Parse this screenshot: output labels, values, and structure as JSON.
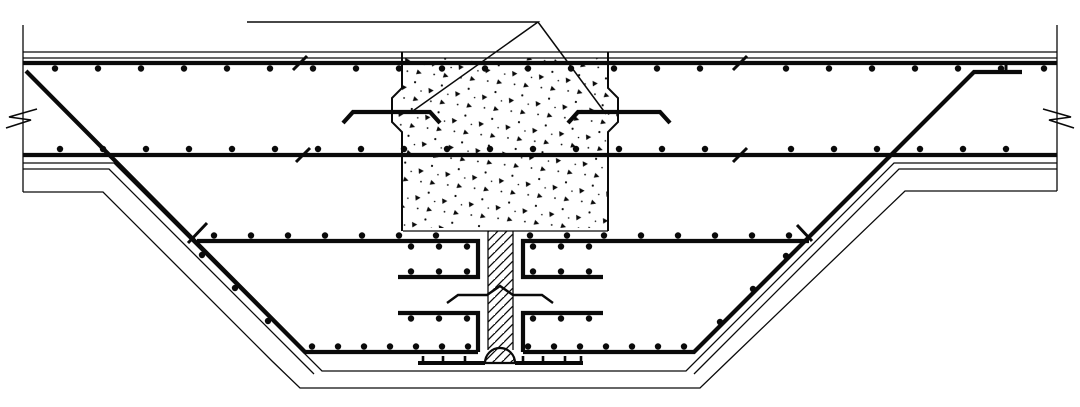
{
  "drawing": {
    "canvas": {
      "width": 1080,
      "height": 407,
      "background": "#ffffff",
      "ink": "#0a0a0a"
    },
    "stipple_block": {
      "name": "concrete-column-stub-stipple",
      "points": [
        [
          402,
          58
        ],
        [
          402,
          88
        ],
        [
          392,
          98
        ],
        [
          392,
          122
        ],
        [
          402,
          132
        ],
        [
          402,
          228
        ],
        [
          608,
          228
        ],
        [
          608,
          132
        ],
        [
          618,
          122
        ],
        [
          618,
          98
        ],
        [
          608,
          88
        ],
        [
          608,
          58
        ]
      ]
    },
    "joint_strip": {
      "name": "construction-joint-hatch",
      "x": 488.5,
      "y": 231,
      "w": 24,
      "h": 120
    },
    "waterstop_bulb": {
      "name": "waterstop-bulb",
      "cx": 500,
      "cy": 363,
      "r": 15,
      "stroke_width": 2.2
    },
    "line_groups": [
      {
        "name": "slab-face-lines",
        "width": 1.3,
        "lines": [
          [
            [
              23,
              52
            ],
            [
              1057,
              52
            ]
          ],
          [
            [
              23,
              58
            ],
            [
              1057,
              58
            ]
          ],
          [
            [
              23,
              163
            ],
            [
              114,
              163
            ],
            [
              322,
              371
            ],
            [
              686,
              371
            ],
            [
              894,
              163
            ],
            [
              1057,
              163
            ]
          ],
          [
            [
              23,
              169
            ],
            [
              109,
              169
            ],
            [
              314,
              374
            ]
          ],
          [
            [
              1057,
              169
            ],
            [
              899,
              169
            ],
            [
              694,
              374
            ]
          ]
        ]
      },
      {
        "name": "excavation-outline",
        "width": 1.3,
        "lines": [
          [
            [
              23,
              192
            ],
            [
              103,
              192
            ],
            [
              272,
              361
            ],
            [
              300,
              388
            ],
            [
              700,
              388
            ],
            [
              728,
              361
            ],
            [
              905,
              191
            ],
            [
              1057,
              191
            ]
          ]
        ]
      },
      {
        "name": "section-edge-lines",
        "width": 1.3,
        "lines": [
          [
            [
              23,
              25
            ],
            [
              23,
              192
            ]
          ],
          [
            [
              1057,
              25
            ],
            [
              1057,
              191
            ]
          ]
        ]
      },
      {
        "name": "block-bottom-and-strip-edges",
        "width": 1.3,
        "lines": [
          [
            [
              403,
              231
            ],
            [
              608,
              231
            ]
          ],
          [
            [
              488,
              231
            ],
            [
              488,
              350
            ]
          ],
          [
            [
              513,
              231
            ],
            [
              513,
              350
            ]
          ]
        ]
      },
      {
        "name": "callout-leader-triangle",
        "width": 1.5,
        "lines": [
          [
            [
              247,
              22
            ],
            [
              538,
              22
            ],
            [
              410,
              113
            ]
          ],
          [
            [
              538,
              22
            ],
            [
              606,
              114
            ]
          ]
        ]
      },
      {
        "name": "block-outline",
        "width": 2,
        "lines": [
          [
            [
              402,
              52
            ],
            [
              402,
              88
            ],
            [
              392,
              98
            ],
            [
              392,
              122
            ],
            [
              402,
              132
            ],
            [
              402,
              231
            ]
          ],
          [
            [
              608,
              52
            ],
            [
              608,
              88
            ],
            [
              618,
              98
            ],
            [
              618,
              122
            ],
            [
              608,
              132
            ],
            [
              608,
              231
            ]
          ]
        ]
      },
      {
        "name": "slab-rebar-chords",
        "width": 4.2,
        "lines": [
          [
            [
              23,
              63
            ],
            [
              1057,
              63
            ]
          ],
          [
            [
              23,
              155
            ],
            [
              1057,
              155
            ]
          ]
        ]
      },
      {
        "name": "bent-slope-bars",
        "width": 4.2,
        "lines": [
          [
            [
              26,
              71
            ],
            [
              305,
              352
            ],
            [
              478,
              352
            ]
          ],
          [
            [
              1022,
              72
            ],
            [
              974,
              72
            ],
            [
              694,
              352
            ],
            [
              523,
              352
            ]
          ]
        ]
      },
      {
        "name": "joint-channel-bars",
        "width": 4.2,
        "lines": [
          [
            [
              197,
              241
            ],
            [
              478,
              241
            ],
            [
              478,
              277
            ],
            [
              398,
              277
            ]
          ],
          [
            [
              809,
              241
            ],
            [
              523,
              241
            ],
            [
              523,
              277
            ],
            [
              603,
              277
            ]
          ],
          [
            [
              478,
              352
            ],
            [
              478,
              313
            ],
            [
              398,
              313
            ]
          ],
          [
            [
              523,
              352
            ],
            [
              523,
              313
            ],
            [
              603,
              313
            ]
          ]
        ]
      },
      {
        "name": "hooked-anchor-bars",
        "width": 4.2,
        "lines": [
          [
            [
              343,
              123
            ],
            [
              353,
              112
            ],
            [
              430,
              112
            ],
            [
              440,
              123
            ]
          ],
          [
            [
              568,
              123
            ],
            [
              578,
              112
            ],
            [
              660,
              112
            ],
            [
              670,
              123
            ]
          ]
        ]
      },
      {
        "name": "waterstop-strip",
        "width": 4,
        "lines": [
          [
            [
              418,
              363
            ],
            [
              485,
              363
            ]
          ],
          [
            [
              515,
              363
            ],
            [
              583,
              363
            ]
          ]
        ]
      },
      {
        "name": "waterstop-ribs",
        "width": 2.6,
        "lines": [
          [
            [
              423,
              356
            ],
            [
              423,
              363
            ]
          ],
          [
            [
              443,
              356
            ],
            [
              443,
              363
            ]
          ],
          [
            [
              465,
              356
            ],
            [
              465,
              363
            ]
          ],
          [
            [
              523,
              356
            ],
            [
              523,
              363
            ]
          ],
          [
            [
              543,
              356
            ],
            [
              543,
              363
            ]
          ],
          [
            [
              565,
              356
            ],
            [
              565,
              363
            ]
          ],
          [
            [
              581,
              356
            ],
            [
              581,
              363
            ]
          ]
        ]
      },
      {
        "name": "bar-cut-ticks",
        "width": 3,
        "lines": [
          [
            [
              293,
              70
            ],
            [
              307,
              56
            ]
          ],
          [
            [
              733,
              70
            ],
            [
              747,
              56
            ]
          ],
          [
            [
              296,
              162
            ],
            [
              310,
              148
            ]
          ],
          [
            [
              733,
              162
            ],
            [
              747,
              148
            ]
          ],
          [
            [
              188,
              243
            ],
            [
              207,
              223
            ]
          ],
          [
            [
              797,
              225
            ],
            [
              812,
              241
            ]
          ],
          [
            [
              1006,
              73
            ],
            [
              1006,
              64
            ]
          ]
        ]
      },
      {
        "name": "steel-waterstop-plate",
        "width": 2.4,
        "lines": [
          [
            [
              447,
              303
            ],
            [
              458,
              295
            ],
            [
              487,
              295
            ],
            [
              500,
              286
            ],
            [
              513,
              295
            ],
            [
              542,
              295
            ],
            [
              553,
              303
            ]
          ]
        ]
      },
      {
        "name": "break-marks",
        "width": 1.6,
        "lines": [
          [
            [
              37,
              109
            ],
            [
              9,
              117
            ],
            [
              31,
              120
            ],
            [
              6,
              128
            ]
          ],
          [
            [
              1043,
              109
            ],
            [
              1071,
              117
            ],
            [
              1049,
              120
            ],
            [
              1074,
              128
            ]
          ]
        ]
      }
    ],
    "dot_groups": [
      {
        "name": "top-bar-dots",
        "r": 3.2,
        "rows": [
          {
            "y": 68.5,
            "xs": [
              55,
              98,
              141,
              184,
              227,
              270,
              313,
              356,
              399,
              442,
              485,
              528,
              571,
              614,
              657,
              700,
              786,
              829,
              872,
              915,
              958,
              1001,
              1044
            ]
          }
        ]
      },
      {
        "name": "bottom-bar-dots",
        "r": 3.2,
        "rows": [
          {
            "y": 149,
            "xs": [
              60,
              103,
              146,
              189,
              232,
              275,
              318,
              361,
              404,
              447,
              490,
              533,
              576,
              619,
              662,
              705,
              791,
              834,
              877,
              920,
              963,
              1006
            ]
          }
        ]
      },
      {
        "name": "middle-bar-dots",
        "r": 3.2,
        "rows": [
          {
            "y": 235.5,
            "xs": [
              214,
              251,
              288,
              325,
              362,
              399,
              436,
              530,
              567,
              604,
              641,
              678,
              715,
              752,
              789
            ]
          },
          {
            "y": 246.5,
            "xs": [
              411,
              439,
              467,
              533,
              561,
              589
            ]
          }
        ]
      },
      {
        "name": "channel-bar-dots",
        "r": 3.2,
        "rows": [
          {
            "y": 271.5,
            "xs": [
              411,
              439,
              467,
              533,
              561,
              589
            ]
          },
          {
            "y": 318.5,
            "xs": [
              411,
              439,
              467,
              533,
              561,
              589
            ]
          }
        ]
      },
      {
        "name": "floor-bar-dots",
        "r": 3.2,
        "rows": [
          {
            "y": 346.5,
            "xs": [
              312,
              338,
              364,
              390,
              416,
              442,
              468,
              528,
              554,
              580,
              606,
              632,
              658,
              684
            ]
          }
        ]
      },
      {
        "name": "slope-bar-dots",
        "r": 3.2,
        "points": [
          [
            202,
            255
          ],
          [
            235,
            288
          ],
          [
            268,
            321
          ],
          [
            786,
            256
          ],
          [
            753,
            289
          ],
          [
            720,
            322
          ]
        ]
      }
    ]
  }
}
